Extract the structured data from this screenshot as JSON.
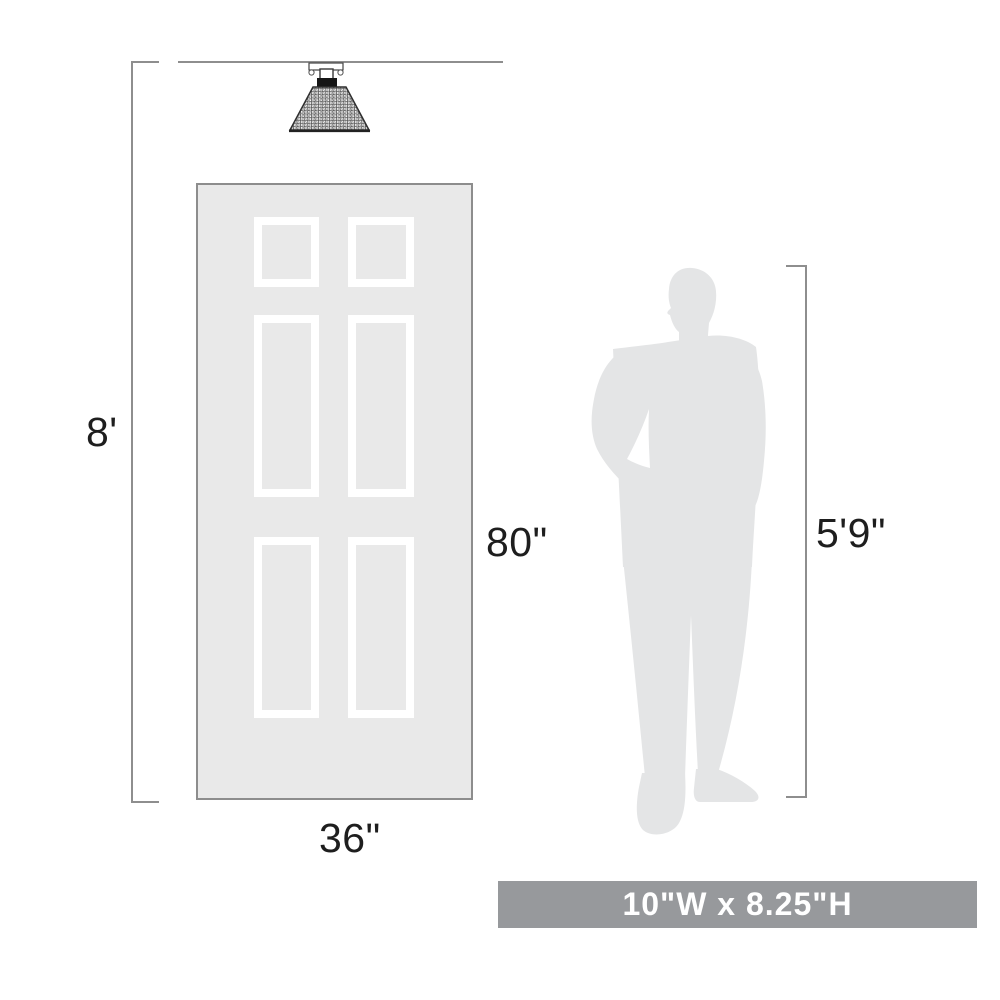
{
  "labels": {
    "ceiling_height": "8'",
    "door_height": "80\"",
    "door_width": "36\"",
    "person_height": "5'9\"",
    "product_size": "10\"W x 8.25\"H"
  },
  "icons": {
    "light_fixture": "semi-flush-ceiling-light-icon",
    "door": "six-panel-door-illustration",
    "person": "standing-man-silhouette"
  },
  "colors": {
    "dimension_line": "#8e8e8e",
    "label_text": "#1e1e1e",
    "door_fill": "#e9e9e9",
    "door_border": "#8d8d8d",
    "silhouette_fill": "#e4e5e6",
    "lamp_outline": "#2f2f2f",
    "banner_background": "#97999c",
    "banner_text": "#ffffff"
  }
}
